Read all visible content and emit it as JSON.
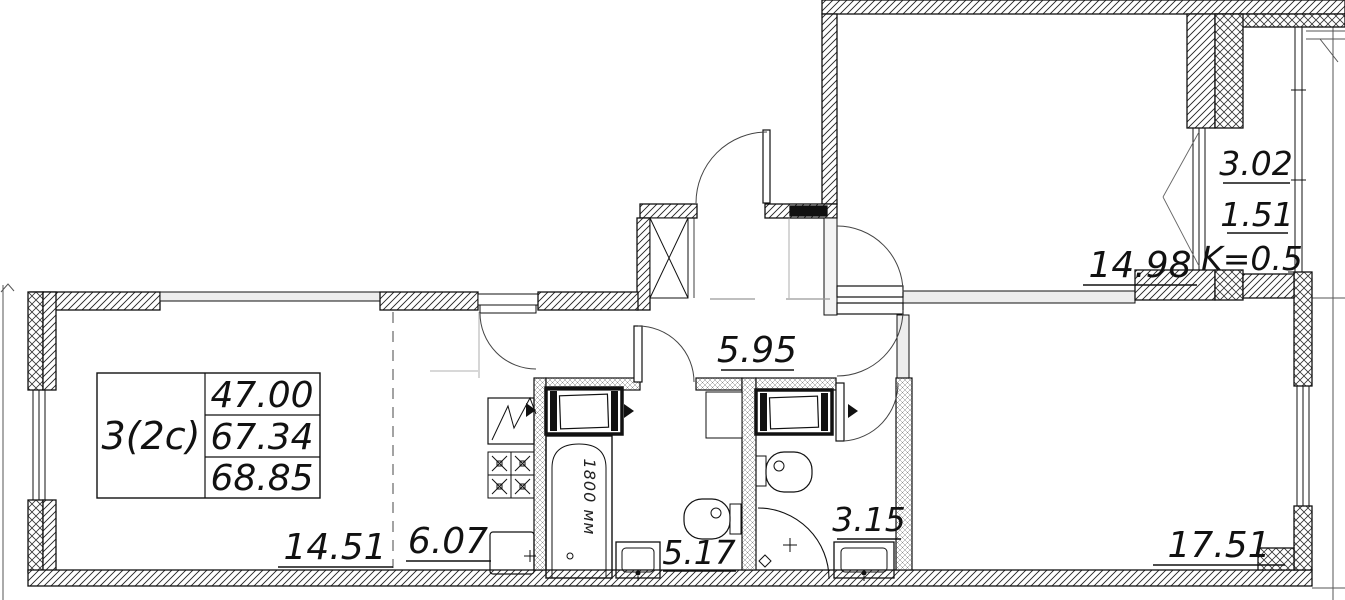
{
  "plan": {
    "info": {
      "type": "3(2c)",
      "values": [
        "47.00",
        "67.34",
        "68.85"
      ]
    },
    "rooms": {
      "living": "14.51",
      "kitchen": "6.07",
      "bathroom": "5.17",
      "wc": "3.15",
      "hall": "5.95",
      "bedroom": "14.98",
      "room": "17.51"
    },
    "balcony": {
      "area": "3.02",
      "reduced": "1.51",
      "coef": "K=0.5"
    },
    "bathtub_length": "1800 мм",
    "colors": {
      "line": "#111111",
      "background": "#ffffff"
    }
  }
}
